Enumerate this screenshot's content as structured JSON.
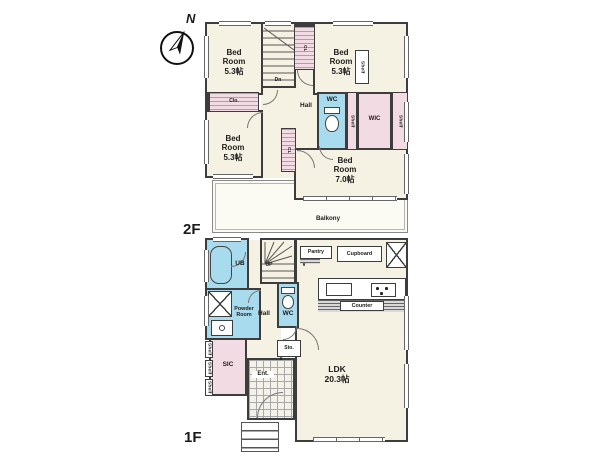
{
  "compass": {
    "north_label": "N"
  },
  "symbols": {
    "door_fold_mark": "∨"
  },
  "colors": {
    "wall": "#3d3d3d",
    "floor": "#f6f2e3",
    "pink": "#f3dbe3",
    "blue": "#a8dbee",
    "line": "#8a8a8a",
    "paper": "#ffffff",
    "text": "#1c1c1c",
    "balcony": "#fbfaf3"
  },
  "f2": {
    "floor_label": "2F",
    "bedroom_nw": {
      "name": "Bed Room",
      "area": "5.3帖"
    },
    "bedroom_ne": {
      "name": "Bed Room",
      "area": "5.3帖"
    },
    "bedroom_w": {
      "name": "Bed Room",
      "area": "5.3帖"
    },
    "bedroom_se": {
      "name": "Bed Room",
      "area": "7.0帖"
    },
    "hall": "Hall",
    "wc": "WC",
    "wic": "WIC",
    "closet": "Clo.",
    "closet_a": "CL",
    "closet_b": "CL",
    "shelf_left": "Shelf",
    "shelf_right": "Shelf",
    "shelf_bedroom": "Shelf",
    "stairs_down": "Dn",
    "balcony": "Balkony"
  },
  "f1": {
    "floor_label": "1F",
    "ub": "UB",
    "powder_room": "Powder Room",
    "hall": "Hall",
    "wc": "WC",
    "stairs_up": "UP",
    "pantry": "Pantry",
    "cupboard": "Cupboard",
    "counter": "Counter",
    "ldk": {
      "name": "LDK",
      "area": "20.3帖"
    },
    "sic": "SIC",
    "shelf_1": "Shelf",
    "shelf_2": "Shelf",
    "shelf_3": "Shelf",
    "entrance": "Ent.",
    "storage": "Sto."
  }
}
